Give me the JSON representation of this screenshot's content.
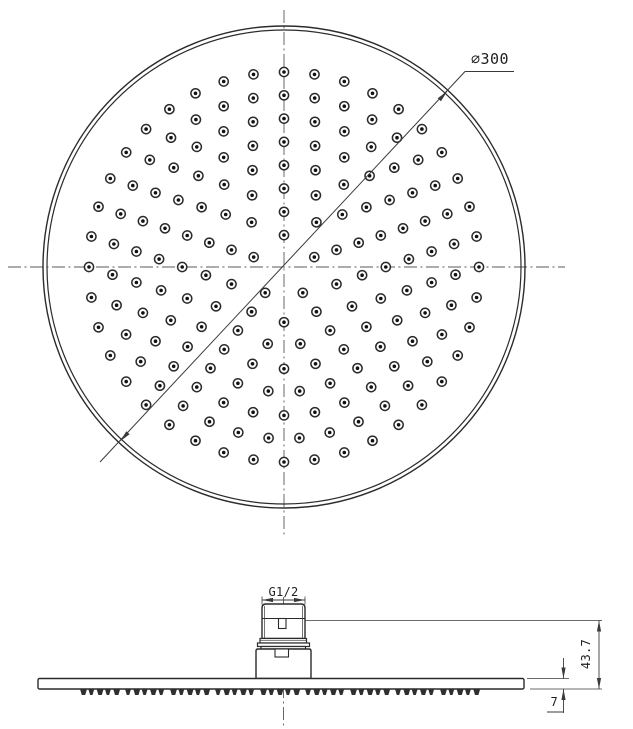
{
  "labels": {
    "diameter": "∅300",
    "thread": "G1/2",
    "head_height": "43.7",
    "plate_thickness": "7"
  },
  "colors": {
    "line": "#2b2b2b",
    "thin": "#3a3a3a",
    "centerline": "#5a5a5a",
    "nozzle_dot": "#111111",
    "background": "#ffffff"
  },
  "top_view": {
    "center": {
      "x": 284,
      "y": 267
    },
    "outer_r": 241,
    "inner_r": 237,
    "centerline_h": {
      "x1": 8,
      "x2": 565,
      "y": 267
    },
    "centerline_v": {
      "x": 284,
      "y1": 10,
      "y2": 538
    },
    "rings": {
      "count": 8,
      "first_r": 31.9,
      "spacing": 23.3,
      "per_ring_step": 5,
      "start_deg": 90
    },
    "nozzle": {
      "r": 4.6,
      "dot_r": 1.8
    },
    "dim": {
      "line": {
        "x1": 100,
        "y1": 462,
        "x2": 465,
        "y2": 71.5
      },
      "leader_x2": 514,
      "arrow1": {
        "x": 447.5,
        "y": 91,
        "deg": -46.9
      },
      "arrow2": {
        "x": 119.8,
        "y": 441.5,
        "deg": 133.1
      },
      "label_x": 490,
      "label_y": 64
    }
  },
  "side_view": {
    "centerline": {
      "x": 283.5,
      "y1": 597,
      "y2": 727
    },
    "plate": {
      "x": 38,
      "y": 678.5,
      "w": 486,
      "h": 10.5
    },
    "teeth": {
      "x1": 80,
      "x2": 487,
      "top": 689,
      "h": 6,
      "tooth_w": 7,
      "pitch": 8.3,
      "group": 5,
      "group_gap": 3.5
    },
    "fitting": {
      "x": 262,
      "y": 604,
      "w": 43,
      "h": 34.5,
      "corner": 4,
      "shoulder_y": 618.5,
      "thread_inset": 2.5,
      "slot": {
        "x": 278.5,
        "y": 618.5,
        "w": 7.5,
        "h": 10
      }
    },
    "collar": [
      {
        "x": 260,
        "y": 638.5,
        "w": 46.5,
        "h": 4.5,
        "midline": 640.7
      },
      {
        "x": 257.5,
        "y": 643,
        "w": 52,
        "h": 3.5
      },
      {
        "x": 261,
        "y": 646.5,
        "w": 44.5,
        "h": 2.5
      }
    ],
    "base": {
      "x": 256,
      "y": 649,
      "w": 55,
      "h": 29.5,
      "corner": 2,
      "notch": {
        "x": 275,
        "y": 649,
        "w": 13.5,
        "h": 8
      }
    },
    "dims": {
      "g12": {
        "ext_x1": 262,
        "ext_x2": 305,
        "ext_y1": 596.5,
        "ext_y2": 604.5,
        "line_y": 600,
        "label_x": 283.5,
        "label_y": 596
      },
      "h437": {
        "ext_top": {
          "x1": 305,
          "x2": 602,
          "y": 620.5
        },
        "ext_bot": {
          "x1": 530,
          "x2": 602,
          "y": 689
        },
        "line_x": 599,
        "y1": 620.5,
        "y2": 689,
        "label_x": 590,
        "label_y": 654
      },
      "t7": {
        "ext": {
          "x1": 527,
          "x2": 569,
          "y": 678.5
        },
        "line_x": 563.5,
        "up_y": 658,
        "down_y": 713,
        "plate_top": 678.5,
        "plate_bot": 689,
        "label_x": 558,
        "label_y": 706,
        "underline": {
          "x1": 547,
          "x2": 563.5,
          "y": 712
        }
      }
    }
  }
}
